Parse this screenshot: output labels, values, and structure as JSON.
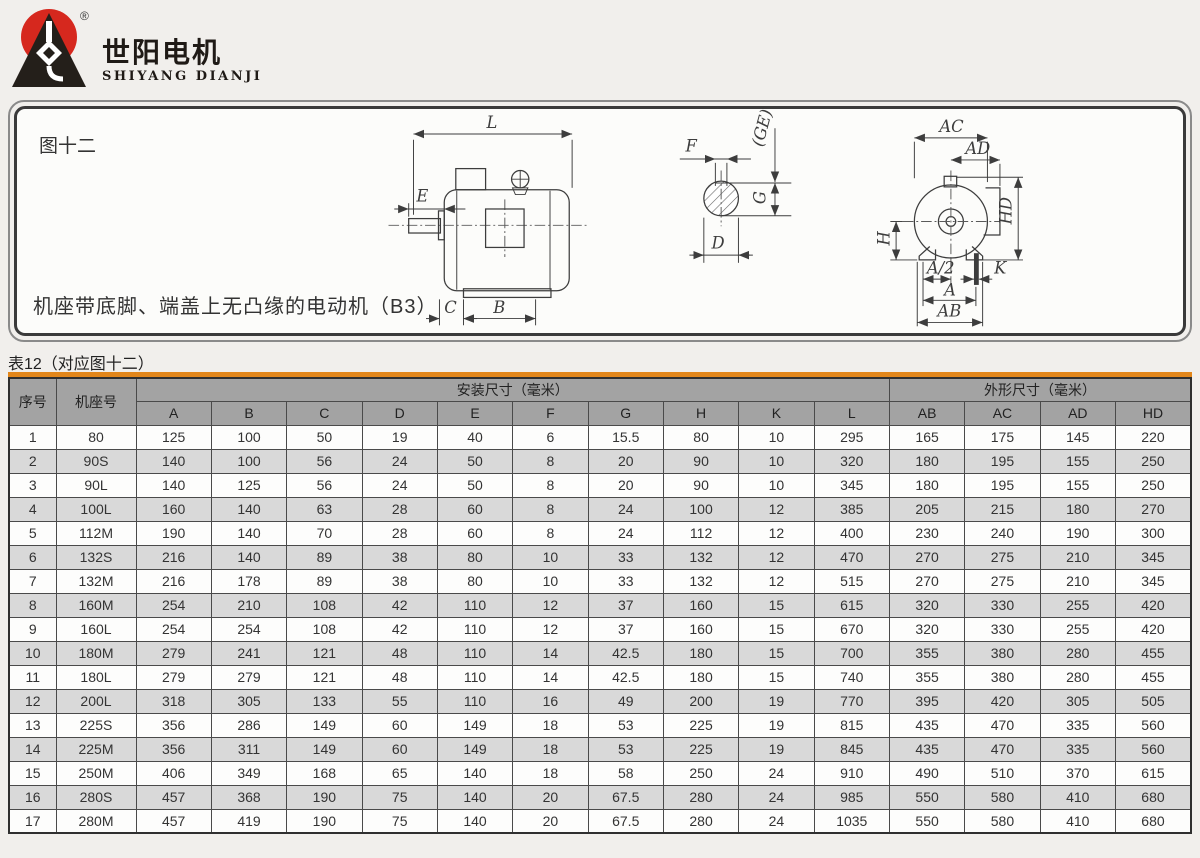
{
  "logo": {
    "name_cn": "世阳电机",
    "name_en": "SHIYANG DIANJI",
    "registered_mark": "®"
  },
  "figure": {
    "label": "图十二",
    "caption": "机座带底脚、端盖上无凸缘的电动机（B3）",
    "dims": {
      "L": "L",
      "E": "E",
      "C": "C",
      "B": "B",
      "F": "F",
      "GE": "(GE)",
      "G": "G",
      "D": "D",
      "AC": "AC",
      "AD": "AD",
      "HD": "HD",
      "H": "H",
      "A2": "A/2",
      "K": "K",
      "A": "A",
      "AB": "AB"
    }
  },
  "table": {
    "title": "表12（对应图十二）",
    "header": {
      "col_no": "序号",
      "col_frame": "机座号",
      "group_install": "安装尺寸（毫米）",
      "group_outline": "外形尺寸（毫米）",
      "install_cols": [
        "A",
        "B",
        "C",
        "D",
        "E",
        "F",
        "G",
        "H",
        "K",
        "L"
      ],
      "outline_cols": [
        "AB",
        "AC",
        "AD",
        "HD"
      ]
    },
    "rows": [
      [
        "1",
        "80",
        "125",
        "100",
        "50",
        "19",
        "40",
        "6",
        "15.5",
        "80",
        "10",
        "295",
        "165",
        "175",
        "145",
        "220"
      ],
      [
        "2",
        "90S",
        "140",
        "100",
        "56",
        "24",
        "50",
        "8",
        "20",
        "90",
        "10",
        "320",
        "180",
        "195",
        "155",
        "250"
      ],
      [
        "3",
        "90L",
        "140",
        "125",
        "56",
        "24",
        "50",
        "8",
        "20",
        "90",
        "10",
        "345",
        "180",
        "195",
        "155",
        "250"
      ],
      [
        "4",
        "100L",
        "160",
        "140",
        "63",
        "28",
        "60",
        "8",
        "24",
        "100",
        "12",
        "385",
        "205",
        "215",
        "180",
        "270"
      ],
      [
        "5",
        "112M",
        "190",
        "140",
        "70",
        "28",
        "60",
        "8",
        "24",
        "112",
        "12",
        "400",
        "230",
        "240",
        "190",
        "300"
      ],
      [
        "6",
        "132S",
        "216",
        "140",
        "89",
        "38",
        "80",
        "10",
        "33",
        "132",
        "12",
        "470",
        "270",
        "275",
        "210",
        "345"
      ],
      [
        "7",
        "132M",
        "216",
        "178",
        "89",
        "38",
        "80",
        "10",
        "33",
        "132",
        "12",
        "515",
        "270",
        "275",
        "210",
        "345"
      ],
      [
        "8",
        "160M",
        "254",
        "210",
        "108",
        "42",
        "110",
        "12",
        "37",
        "160",
        "15",
        "615",
        "320",
        "330",
        "255",
        "420"
      ],
      [
        "9",
        "160L",
        "254",
        "254",
        "108",
        "42",
        "110",
        "12",
        "37",
        "160",
        "15",
        "670",
        "320",
        "330",
        "255",
        "420"
      ],
      [
        "10",
        "180M",
        "279",
        "241",
        "121",
        "48",
        "110",
        "14",
        "42.5",
        "180",
        "15",
        "700",
        "355",
        "380",
        "280",
        "455"
      ],
      [
        "11",
        "180L",
        "279",
        "279",
        "121",
        "48",
        "110",
        "14",
        "42.5",
        "180",
        "15",
        "740",
        "355",
        "380",
        "280",
        "455"
      ],
      [
        "12",
        "200L",
        "318",
        "305",
        "133",
        "55",
        "110",
        "16",
        "49",
        "200",
        "19",
        "770",
        "395",
        "420",
        "305",
        "505"
      ],
      [
        "13",
        "225S",
        "356",
        "286",
        "149",
        "60",
        "149",
        "18",
        "53",
        "225",
        "19",
        "815",
        "435",
        "470",
        "335",
        "560"
      ],
      [
        "14",
        "225M",
        "356",
        "311",
        "149",
        "60",
        "149",
        "18",
        "53",
        "225",
        "19",
        "845",
        "435",
        "470",
        "335",
        "560"
      ],
      [
        "15",
        "250M",
        "406",
        "349",
        "168",
        "65",
        "140",
        "18",
        "58",
        "250",
        "24",
        "910",
        "490",
        "510",
        "370",
        "615"
      ],
      [
        "16",
        "280S",
        "457",
        "368",
        "190",
        "75",
        "140",
        "20",
        "67.5",
        "280",
        "24",
        "985",
        "550",
        "580",
        "410",
        "680"
      ],
      [
        "17",
        "280M",
        "457",
        "419",
        "190",
        "75",
        "140",
        "20",
        "67.5",
        "280",
        "24",
        "1035",
        "550",
        "580",
        "410",
        "680"
      ]
    ]
  },
  "colors": {
    "accent_orange": "#e2861a",
    "header_gray": "#a3a3a3",
    "row_alt_gray": "#d9d9d9",
    "logo_red": "#d6281e"
  }
}
